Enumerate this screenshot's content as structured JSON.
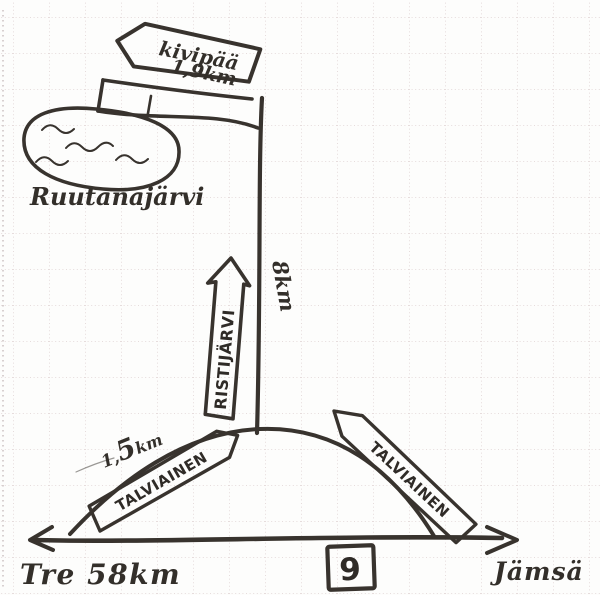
{
  "map": {
    "type": "hand-drawn-road-sketch",
    "top_sign": {
      "destination": "kivipää",
      "distance": "1,9km"
    },
    "lake": {
      "name": "Ruutanajärvi"
    },
    "side_road": {
      "sign": "RISTIJÄRVI",
      "distance": "8km"
    },
    "loop_road": {
      "sign_left": "TALVIAINEN",
      "sign_right": "TALVIAINEN",
      "distance_prefix": "1,",
      "distance_big_digit": "5",
      "distance_suffix": "km"
    },
    "highway": {
      "left_destination": "Tre 58km",
      "right_destination": "Jämsä",
      "route_number": "9"
    },
    "colors": {
      "ink": "#38332e",
      "paper": "#fdfdfc",
      "grid": "#ded1d1"
    }
  }
}
